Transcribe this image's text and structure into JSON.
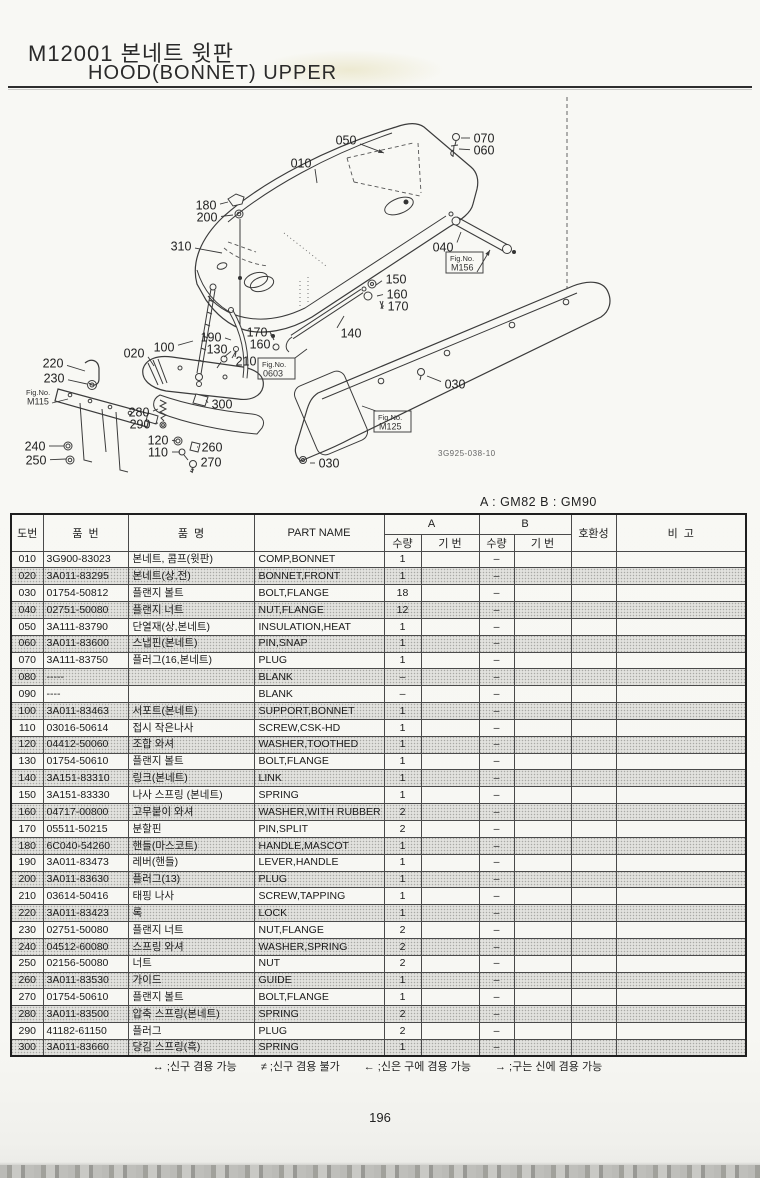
{
  "page": {
    "code_title": "M12001 본네트 윗판",
    "title_en": "HOOD(BONNET) UPPER",
    "variant_note": "A : GM82   B : GM90",
    "drawing_code": "3G925-038-10",
    "number": "196"
  },
  "diagram": {
    "fig_label": "Fig.No.",
    "fig_refs": [
      {
        "code": "M115",
        "x": 22,
        "y": 386,
        "boxed": false,
        "line": [
          52,
          403,
          68,
          399
        ]
      },
      {
        "code": "0603",
        "x": 258,
        "y": 358,
        "boxed": true,
        "line": [
          295,
          358,
          307,
          349
        ]
      },
      {
        "code": "M125",
        "x": 374,
        "y": 411,
        "boxed": true,
        "line": [
          376,
          411,
          362,
          406
        ]
      },
      {
        "code": "M156",
        "x": 446,
        "y": 252,
        "boxed": true,
        "line": [
          477,
          272,
          490,
          250
        ],
        "ah": 1
      }
    ],
    "callouts": [
      {
        "t": "050",
        "x": 346,
        "y": 140,
        "lx": 384,
        "ly": 153,
        "ah": 1
      },
      {
        "t": "070",
        "x": 484,
        "y": 138,
        "lx": 461,
        "ly": 138
      },
      {
        "t": "060",
        "x": 484,
        "y": 150,
        "lx": 459,
        "ly": 149
      },
      {
        "t": "010",
        "x": 301,
        "y": 163,
        "lx": 317,
        "ly": 183
      },
      {
        "t": "180",
        "x": 206,
        "y": 205,
        "lx": 228,
        "ly": 202
      },
      {
        "t": "200",
        "x": 207,
        "y": 217,
        "lx": 233,
        "ly": 215
      },
      {
        "t": "310",
        "x": 181,
        "y": 246,
        "lx": 222,
        "ly": 253
      },
      {
        "t": "040",
        "x": 443,
        "y": 247,
        "lx": 461,
        "ly": 232
      },
      {
        "t": "150",
        "x": 396,
        "y": 279,
        "lx": 376,
        "ly": 285
      },
      {
        "t": "160",
        "x": 397,
        "y": 294,
        "lx": 377,
        "ly": 296
      },
      {
        "t": "170",
        "x": 398,
        "y": 306,
        "lx": 382,
        "ly": 306
      },
      {
        "t": "170",
        "x": 257,
        "y": 332,
        "lx": 271,
        "ly": 336
      },
      {
        "t": "160",
        "x": 260,
        "y": 344,
        "lx": 274,
        "ly": 346
      },
      {
        "t": "210",
        "x": 246,
        "y": 361,
        "lx": 236,
        "ly": 351
      },
      {
        "t": "140",
        "x": 351,
        "y": 333,
        "lx": 344,
        "ly": 316
      },
      {
        "t": "030",
        "x": 455,
        "y": 384,
        "lx": 427,
        "ly": 376
      },
      {
        "t": "020",
        "x": 134,
        "y": 353,
        "lx": 154,
        "ly": 366
      },
      {
        "t": "100",
        "x": 164,
        "y": 347,
        "lx": 193,
        "ly": 341
      },
      {
        "t": "190",
        "x": 211,
        "y": 337,
        "lx": 231,
        "ly": 340
      },
      {
        "t": "130",
        "x": 217,
        "y": 349,
        "lx": 224,
        "ly": 357
      },
      {
        "t": "220",
        "x": 53,
        "y": 363,
        "lx": 85,
        "ly": 371
      },
      {
        "t": "230",
        "x": 54,
        "y": 378,
        "lx": 87,
        "ly": 384
      },
      {
        "t": "240",
        "x": 35,
        "y": 446,
        "lx": 64,
        "ly": 446
      },
      {
        "t": "250",
        "x": 36,
        "y": 460,
        "lx": 66,
        "ly": 459
      },
      {
        "t": "280",
        "x": 139,
        "y": 412,
        "lx": 158,
        "ly": 409
      },
      {
        "t": "290",
        "x": 140,
        "y": 424,
        "lx": 158,
        "ly": 423
      },
      {
        "t": "120",
        "x": 158,
        "y": 440,
        "lx": 176,
        "ly": 441
      },
      {
        "t": "110",
        "x": 158,
        "y": 452,
        "lx": 180,
        "ly": 452
      },
      {
        "t": "300",
        "x": 222,
        "y": 404,
        "lx": 206,
        "ly": 400
      },
      {
        "t": "260",
        "x": 212,
        "y": 447,
        "lx": 197,
        "ly": 447
      },
      {
        "t": "270",
        "x": 211,
        "y": 462,
        "lx": 197,
        "ly": 462
      },
      {
        "t": "030",
        "x": 329,
        "y": 463,
        "lx": 310,
        "ly": 463
      }
    ]
  },
  "table": {
    "headers": {
      "ref": "도번",
      "part_no": "품  번",
      "name_ko": "품  명",
      "part_name": "PART NAME",
      "a": "A",
      "b": "B",
      "qty": "수량",
      "serial": "기 번",
      "compat": "호환성",
      "remarks": "비  고"
    },
    "rows": [
      [
        "010",
        "3G900-83023",
        "본네트, 콤프(윗판)",
        "COMP,BONNET",
        "1",
        "",
        "–",
        "",
        "",
        ""
      ],
      [
        "020",
        "3A011-83295",
        "본네트(상,전)",
        "BONNET,FRONT",
        "1",
        "",
        "–",
        "",
        "",
        ""
      ],
      [
        "030",
        "01754-50812",
        "플랜지 볼트",
        "BOLT,FLANGE",
        "18",
        "",
        "–",
        "",
        "",
        ""
      ],
      [
        "040",
        "02751-50080",
        "플랜지 너트",
        "NUT,FLANGE",
        "12",
        "",
        "–",
        "",
        "",
        ""
      ],
      [
        "050",
        "3A111-83790",
        "단열재(상,본네트)",
        "INSULATION,HEAT",
        "1",
        "",
        "–",
        "",
        "",
        ""
      ],
      [
        "060",
        "3A011-83600",
        "스냅핀(본네트)",
        "PIN,SNAP",
        "1",
        "",
        "–",
        "",
        "",
        ""
      ],
      [
        "070",
        "3A111-83750",
        "플러그(16,본네트)",
        "PLUG",
        "1",
        "",
        "–",
        "",
        "",
        ""
      ],
      [
        "080",
        "-----",
        "",
        "BLANK",
        "–",
        "",
        "–",
        "",
        "",
        ""
      ],
      [
        "090",
        "----",
        "",
        "BLANK",
        "–",
        "",
        "–",
        "",
        "",
        ""
      ],
      [
        "100",
        "3A011-83463",
        "서포트(본네트)",
        "SUPPORT,BONNET",
        "1",
        "",
        "–",
        "",
        "",
        ""
      ],
      [
        "110",
        "03016-50614",
        "접시 작은나사",
        "SCREW,CSK-HD",
        "1",
        "",
        "–",
        "",
        "",
        ""
      ],
      [
        "120",
        "04412-50060",
        "조합 와셔",
        "WASHER,TOOTHED",
        "1",
        "",
        "–",
        "",
        "",
        ""
      ],
      [
        "130",
        "01754-50610",
        "플랜지 볼트",
        "BOLT,FLANGE",
        "1",
        "",
        "–",
        "",
        "",
        ""
      ],
      [
        "140",
        "3A151-83310",
        "링크(본네트)",
        "LINK",
        "1",
        "",
        "–",
        "",
        "",
        ""
      ],
      [
        "150",
        "3A151-83330",
        "나사 스프링 (본네트)",
        "SPRING",
        "1",
        "",
        "–",
        "",
        "",
        ""
      ],
      [
        "160",
        "04717-00800",
        "고무붙이 와셔",
        "WASHER,WITH RUBBER",
        "2",
        "",
        "–",
        "",
        "",
        ""
      ],
      [
        "170",
        "05511-50215",
        "분할핀",
        "PIN,SPLIT",
        "2",
        "",
        "–",
        "",
        "",
        ""
      ],
      [
        "180",
        "6C040-54260",
        "핸들(마스코트)",
        "HANDLE,MASCOT",
        "1",
        "",
        "–",
        "",
        "",
        ""
      ],
      [
        "190",
        "3A011-83473",
        "레버(핸들)",
        "LEVER,HANDLE",
        "1",
        "",
        "–",
        "",
        "",
        ""
      ],
      [
        "200",
        "3A011-83630",
        "플러그(13)",
        "PLUG",
        "1",
        "",
        "–",
        "",
        "",
        ""
      ],
      [
        "210",
        "03614-50416",
        "태핑 나사",
        "SCREW,TAPPING",
        "1",
        "",
        "–",
        "",
        "",
        ""
      ],
      [
        "220",
        "3A011-83423",
        "록",
        "LOCK",
        "1",
        "",
        "–",
        "",
        "",
        ""
      ],
      [
        "230",
        "02751-50080",
        "플랜지 너트",
        "NUT,FLANGE",
        "2",
        "",
        "–",
        "",
        "",
        ""
      ],
      [
        "240",
        "04512-60080",
        "스프링 와셔",
        "WASHER,SPRING",
        "2",
        "",
        "–",
        "",
        "",
        ""
      ],
      [
        "250",
        "02156-50080",
        "너트",
        "NUT",
        "2",
        "",
        "–",
        "",
        "",
        ""
      ],
      [
        "260",
        "3A011-83530",
        "가이드",
        "GUIDE",
        "1",
        "",
        "–",
        "",
        "",
        ""
      ],
      [
        "270",
        "01754-50610",
        "플랜지 볼트",
        "BOLT,FLANGE",
        "1",
        "",
        "–",
        "",
        "",
        ""
      ],
      [
        "280",
        "3A011-83500",
        "압축 스프링(본네트)",
        "SPRING",
        "2",
        "",
        "–",
        "",
        "",
        ""
      ],
      [
        "290",
        "41182-61150",
        "플러그",
        "PLUG",
        "2",
        "",
        "–",
        "",
        "",
        ""
      ],
      [
        "300",
        "3A011-83660",
        "당김 스프링(흑)",
        "SPRING",
        "1",
        "",
        "–",
        "",
        "",
        ""
      ]
    ]
  },
  "legend": {
    "items": [
      {
        "symbol": "↔",
        "text": ";신구 겸용 가능"
      },
      {
        "symbol": "≠",
        "text": ";신구 겸용 불가"
      },
      {
        "symbol": "←",
        "text": ";신은 구에 겸용 가능"
      },
      {
        "symbol": "→",
        "text": ";구는 신에 겸용 가능"
      }
    ]
  }
}
